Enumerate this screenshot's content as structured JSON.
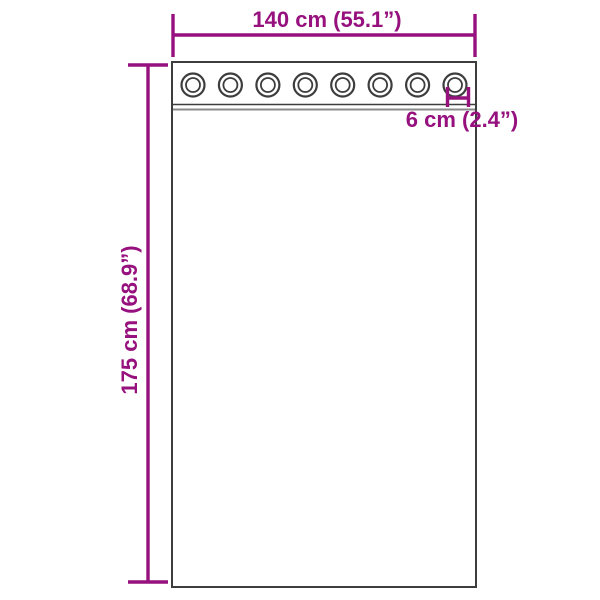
{
  "diagram": {
    "width_label": "140 cm (55.1”)",
    "height_label": "175 cm (68.9”)",
    "grommet_label": "6 cm (2.4”)",
    "measurements": {
      "width_cm": 140,
      "width_in": 55.1,
      "height_cm": 175,
      "height_in": 68.9,
      "grommet_cm": 6,
      "grommet_in": 2.4
    },
    "grommet_count": 8,
    "colors": {
      "accent": "#96117e",
      "outline": "#3d3d3d",
      "hem_gray": "#8a8a8a",
      "background": "#ffffff"
    }
  }
}
